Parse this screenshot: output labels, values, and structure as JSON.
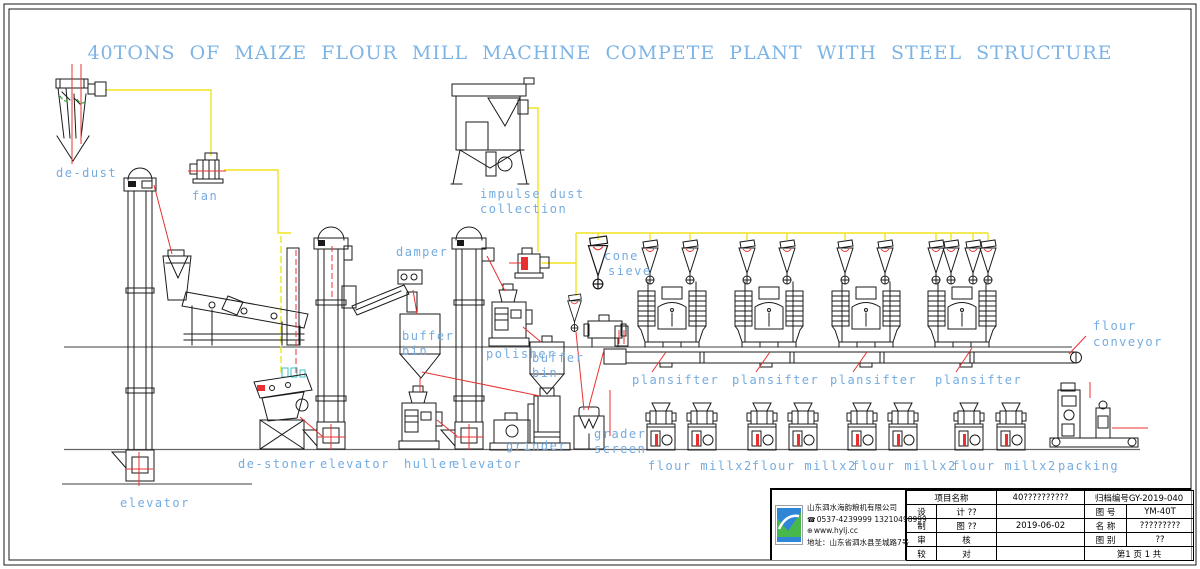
{
  "title": "40TONS OF MAIZE FLOUR MILL MACHINE COMPETE PLANT WITH STEEL STRUCTURE",
  "labels": {
    "de_dust": "de-dust",
    "fan": "fan",
    "impulse_dust_line1": "impulse dust",
    "impulse_dust_line2": "collection",
    "damper": "damper",
    "buffer": "buffer",
    "bin": "bin",
    "polisher": "polisher",
    "cone": "cone",
    "sieve": "sieve",
    "grader": "grader",
    "screen": "screen",
    "grinder": "grinder",
    "de_stoner": "de-stoner",
    "elevator": "elevator",
    "huller": "huller",
    "plansifter": "plansifter",
    "flour_mill_x2": "flour millx2",
    "packing": "packing",
    "flour": "flour",
    "conveyor": "conveyor"
  },
  "title_block": {
    "company": {
      "name": "山东泗水海韵粮机有限公司",
      "phone": "0537-4239999 13210498999",
      "website": "www.hylj.cc",
      "address": "地址：山东省泗水县圣城路7号"
    },
    "project_label": "项目名称",
    "project_value": "40??????????",
    "archive_no": "归档编号GY-2019-040",
    "design_label": "设",
    "design_label2": "计 ??",
    "draft_label": "制",
    "draft_label2": "图 ??",
    "date": "2019-06-02",
    "review_label": "审",
    "review_label2": "核",
    "proof_label": "较",
    "proof_label2": "对",
    "drawing_no_label": "图 号",
    "drawing_no": "YM-40T",
    "name_label": "名 称",
    "name_value": "?????????",
    "category_label": "图 别",
    "category_value": "??",
    "page_info": "第1 页 1 共"
  },
  "colors": {
    "label_blue": "#74ACE0",
    "title_blue": "#7DB4E6",
    "line_red": "#E83030",
    "line_yellow": "#EFE31E",
    "line_green": "#2FA833",
    "drawing_black": "#1A1A1A"
  }
}
